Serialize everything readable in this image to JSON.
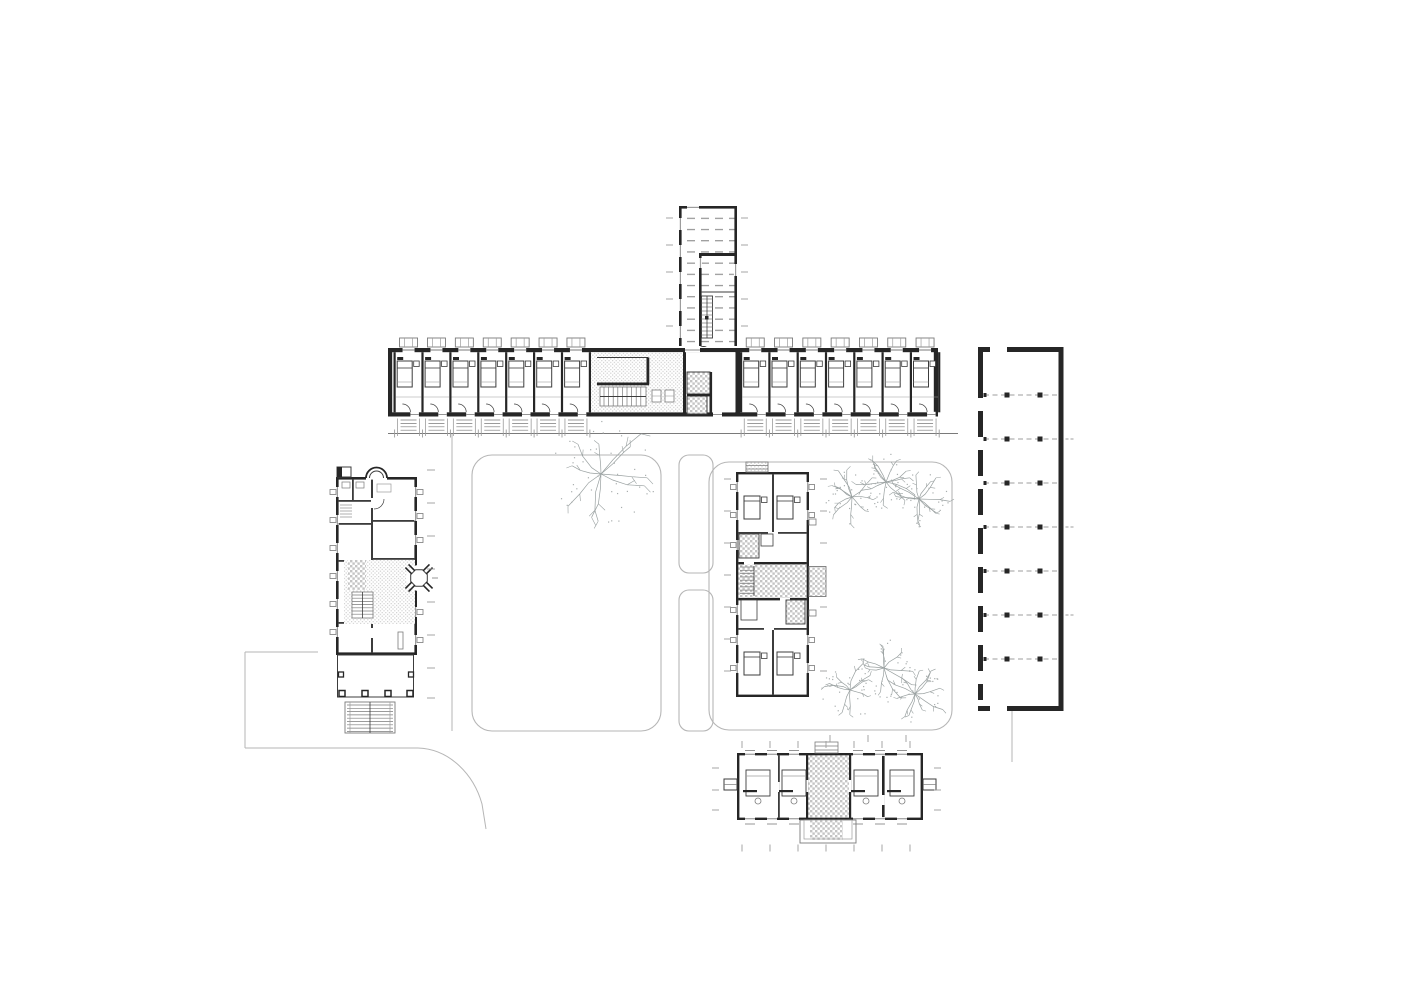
{
  "document": {
    "kind": "architectural-site-plan",
    "level": "ground-floor-plan",
    "background": "#ffffff"
  },
  "colors": {
    "ink": "#1f1f1f",
    "wall": "#262626",
    "thin": "#3c3c3c",
    "mid": "#7a7a7a",
    "light": "#9c9c9c",
    "path": "#b6b6b6",
    "pattern": "#c8c8c8",
    "tree": "#99a0a0",
    "dot": "#a9aeae"
  },
  "canvas": {
    "width": 1414,
    "height": 1000
  },
  "main_wing": {
    "x1": 388,
    "x2": 938,
    "y_top": 348,
    "y_bot": 412.3,
    "wall_t": 4.2,
    "left_modules": {
      "start": 393.5,
      "pitch": 27.9,
      "count": 7
    },
    "right_modules": {
      "start": 740,
      "pitch": 28.3,
      "count": 7
    },
    "lobby": {
      "x1": 591,
      "x2": 683
    },
    "junction": {
      "x1": 683,
      "x2": 737
    },
    "walkway": {
      "y": 433.5,
      "x1": 388,
      "x2": 958
    }
  },
  "north_wing": {
    "x1": 679,
    "x2": 737,
    "y1": 206,
    "y2": 346,
    "window_ys": [
      224,
      251,
      278,
      305,
      332
    ],
    "partition_y": 253,
    "stair": {
      "x": 701.5,
      "y": 296,
      "w": 11,
      "h": 42
    },
    "column": {
      "cx": 703.5,
      "cy": 341,
      "r": 5.5
    },
    "side_tick_ys": [
      218,
      245,
      272,
      299,
      326
    ]
  },
  "carport": {
    "x1": 978,
    "x2": 1063.5,
    "y1": 347,
    "y2": 711,
    "beam_ys": [
      395,
      439,
      483,
      527,
      571,
      615,
      659
    ],
    "post_xs": [
      1007,
      1040
    ],
    "pillar_segs": [
      [
        352,
        46
      ],
      [
        411,
        26
      ],
      [
        450,
        26
      ],
      [
        489,
        26
      ],
      [
        528,
        26
      ],
      [
        567,
        26
      ],
      [
        606,
        26
      ],
      [
        645,
        26
      ],
      [
        684,
        16
      ]
    ],
    "right_stub_ys": [
      439,
      527,
      615
    ],
    "exit_x": 1012
  },
  "villa": {
    "x1": 336,
    "x2": 417,
    "y1": 477,
    "y2": 655,
    "apse": {
      "cx": 376.5,
      "r": 10.5
    },
    "west_window_ys": [
      492,
      520,
      548,
      576,
      604,
      632
    ],
    "east_window_ys": [
      492,
      516,
      540,
      612,
      640
    ],
    "court": {
      "x": 344,
      "y": 560,
      "w": 71,
      "h": 64
    },
    "oct": {
      "cx": 419,
      "cy": 578,
      "r": 9
    },
    "porch": {
      "y1": 655,
      "y2": 697,
      "col_xs": [
        339,
        362,
        385,
        407
      ]
    },
    "stair": {
      "x1": 345,
      "x2": 395,
      "y1": 702,
      "y2": 733
    },
    "east_tick_x": 427,
    "east_tick_ys": [
      470,
      503,
      536,
      569,
      602,
      635,
      668,
      698
    ]
  },
  "central_pavilion": {
    "x1": 736,
    "x2": 809,
    "y1": 472,
    "y2": 697,
    "band_ys": [
      532,
      562,
      598,
      628
    ],
    "mid_x": 772,
    "west_window_ys": [
      487,
      515,
      545,
      610,
      640,
      668
    ],
    "east_window_ys": [
      487,
      515,
      640,
      668
    ],
    "hall": {
      "y1": 564.5,
      "h": 33.5,
      "ext_w": 17,
      "ext_h": 30
    },
    "entry": {
      "x": 746,
      "y": 462,
      "w": 22,
      "h": 10
    },
    "bed_xy": [
      [
        744,
        496
      ],
      [
        777,
        496
      ],
      [
        744,
        652
      ],
      [
        777,
        652
      ]
    ],
    "west_tick_x": 724,
    "west_tick_ys": [
      479,
      511,
      543,
      575,
      607,
      639,
      671
    ],
    "east_tick_x": 820,
    "east_tick_ys": [
      479,
      511,
      543,
      607,
      671
    ]
  },
  "south_pavilion": {
    "x1": 737,
    "x2": 923,
    "y1": 753,
    "y2": 820,
    "hall": {
      "x1": 806,
      "x2": 849
    },
    "thin_part_x": 778,
    "thick_part_x": 882,
    "top_window_xs": [
      750,
      772,
      794,
      858,
      880,
      902
    ],
    "bot_window_xs": [
      750,
      772,
      794,
      858,
      880,
      902
    ],
    "room_sets_x": [
      746,
      782,
      854,
      890
    ],
    "room_sets_y": 770,
    "porch": {
      "x1": 800,
      "x2": 856,
      "y2": 843
    },
    "entry": {
      "x": 815,
      "y": 742,
      "w": 23,
      "h": 11
    },
    "bal_l": {
      "x": 724,
      "y": 779
    },
    "bal_r": {
      "x": 923,
      "y": 779
    },
    "tick_top_y": 744.5,
    "tick_bot_y": 848,
    "tick_xs": [
      742,
      770,
      798,
      826,
      854,
      882,
      910
    ],
    "side_tick_ys": [
      768,
      790,
      810
    ],
    "left_tick_x": 712,
    "right_tick_x": 934
  },
  "courtyards": [
    {
      "name": "west-lawn",
      "x": 472,
      "y": 455,
      "w": 189,
      "h": 276,
      "rx": 20
    },
    {
      "name": "planting-strip-north",
      "x": 679,
      "y": 455,
      "w": 34,
      "h": 118,
      "rx": 10
    },
    {
      "name": "planting-strip-south",
      "x": 679,
      "y": 590,
      "w": 34,
      "h": 141,
      "rx": 10
    },
    {
      "name": "east-lawn",
      "x": 709,
      "y": 462,
      "w": 243,
      "h": 268,
      "rx": 20
    }
  ],
  "roads": {
    "segments": [
      [
        [
          245,
          652
        ],
        [
          318,
          652
        ]
      ],
      [
        [
          245,
          652
        ],
        [
          245,
          748
        ]
      ],
      [
        [
          245,
          748
        ],
        [
          418,
          748
        ]
      ],
      [
        [
          452,
          433.5
        ],
        [
          452,
          731
        ]
      ],
      [
        [
          1012,
          711
        ],
        [
          1012,
          762
        ]
      ]
    ],
    "curve": "M418,748 C450,749 474,775 482,804 L486,829"
  },
  "trees": [
    {
      "cx": 601,
      "cy": 474,
      "r": 56,
      "seed": 11
    },
    {
      "cx": 852,
      "cy": 497,
      "r": 30,
      "seed": 21
    },
    {
      "cx": 886,
      "cy": 482,
      "r": 31,
      "seed": 31
    },
    {
      "cx": 919,
      "cy": 499,
      "r": 30,
      "seed": 41
    },
    {
      "cx": 850,
      "cy": 690,
      "r": 31,
      "seed": 51
    },
    {
      "cx": 884,
      "cy": 668,
      "r": 31,
      "seed": 61
    },
    {
      "cx": 915,
      "cy": 694,
      "r": 30,
      "seed": 71
    }
  ],
  "extra_ticks": [
    {
      "dir": "v",
      "y": 735,
      "len": 7,
      "xs": [
        830,
        868,
        906
      ]
    }
  ]
}
